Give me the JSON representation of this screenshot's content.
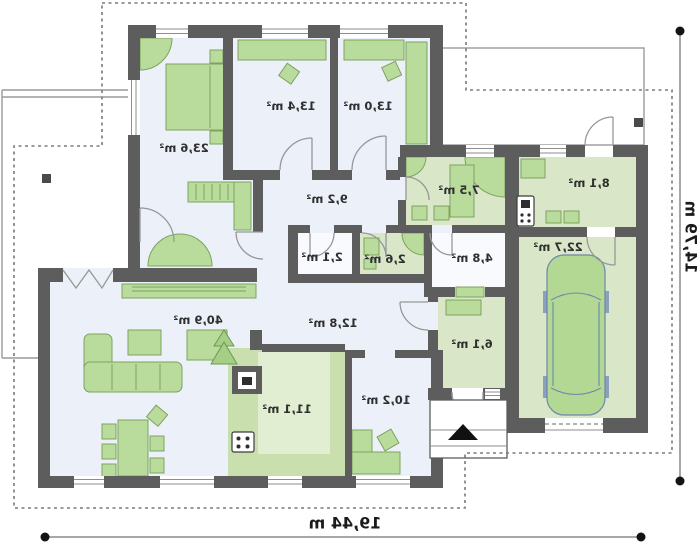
{
  "plan": {
    "rooms": [
      {
        "id": "bedroom-1",
        "area": "23,6 m²"
      },
      {
        "id": "bedroom-2",
        "area": "13,4 m²"
      },
      {
        "id": "bedroom-3",
        "area": "13,0 m²"
      },
      {
        "id": "corridor",
        "area": "9,2 m²"
      },
      {
        "id": "closet",
        "area": "2,1 m²"
      },
      {
        "id": "wc",
        "area": "2,6 m²"
      },
      {
        "id": "bathroom",
        "area": "7,5 m²"
      },
      {
        "id": "pantry",
        "area": "4,8 m²"
      },
      {
        "id": "boiler-room",
        "area": "8,1 m²"
      },
      {
        "id": "garage",
        "area": "22,7 m²"
      },
      {
        "id": "hall",
        "area": "12,8 m²"
      },
      {
        "id": "vestibule",
        "area": "6,1 m²"
      },
      {
        "id": "living-room",
        "area": "40,9 m²"
      },
      {
        "id": "kitchen",
        "area": "11,1 m²"
      },
      {
        "id": "office",
        "area": "10,2 m²"
      }
    ],
    "dimensions": {
      "total_width": "19,44 m",
      "total_depth": "14,79 m"
    },
    "colors": {
      "wall": "#5d5d5d",
      "floor_blue": "#ecf1f9",
      "floor_green": "#d9e7c8",
      "furniture": "#b9dc9c"
    }
  }
}
